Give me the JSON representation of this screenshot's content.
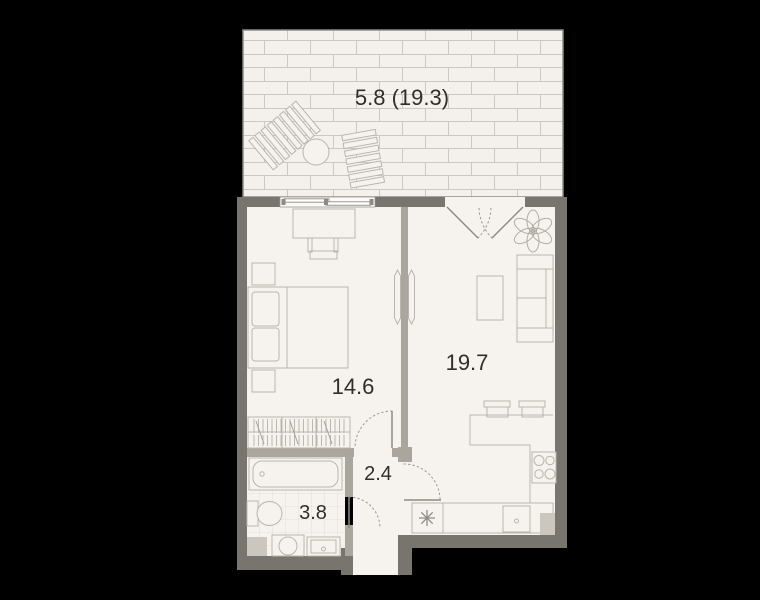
{
  "colors": {
    "background": "#000000",
    "floor": "#f6f3ee",
    "terrace_floor": "#f4f1ec",
    "exterior_wall": "#77756e",
    "partition_wall": "#aba69d",
    "furniture_line": "#b9b4ad",
    "tile_line": "#ded9d2",
    "label_text": "#2f2e29",
    "shaft_fill": "#cbc6be"
  },
  "rooms": {
    "terrace": {
      "label": "5.8 (19.3)"
    },
    "bedroom": {
      "label": "14.6"
    },
    "living": {
      "label": "19.7"
    },
    "hallway": {
      "label": "2.4"
    },
    "bathroom": {
      "label": "3.8"
    }
  },
  "furniture": {
    "terrace": [
      "sun-lounger",
      "round-table",
      "sun-lounger"
    ],
    "bedroom": [
      "desk",
      "chair",
      "nightstand",
      "double-bed",
      "nightstand",
      "wardrobe",
      "wall-tv"
    ],
    "living": [
      "plant",
      "sofa",
      "coffee-table",
      "wall-tv",
      "bar-counter",
      "bar-stool",
      "bar-stool",
      "stove",
      "kitchen-counter",
      "fridge-symbol",
      "kitchen-sink",
      "duct-shaft"
    ],
    "bathroom": [
      "bathtub",
      "toilet",
      "duct-shaft",
      "washing-machine",
      "sink"
    ]
  }
}
